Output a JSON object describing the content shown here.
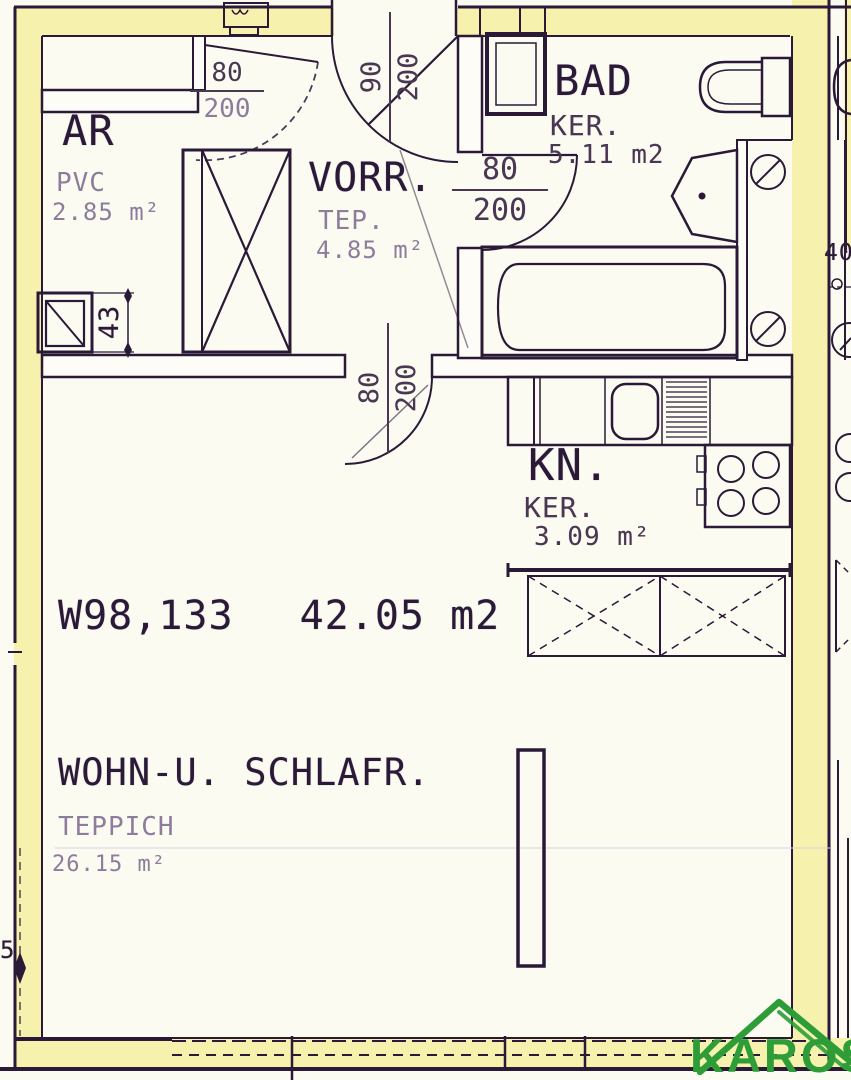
{
  "colors": {
    "highlight": "#f6f2ae",
    "paper": "#fcfbf2",
    "ink": "#2a1a38",
    "mid": "#4a3752",
    "faint": "#8d7c9c",
    "logo_green": "#2e9d38"
  },
  "plan": {
    "unit_id": "W98,133",
    "total_area": "42.05 m2"
  },
  "rooms": {
    "ar": {
      "name": "AR",
      "floor": "PVC",
      "area": "2.85 m²"
    },
    "vorr": {
      "name": "VORR.",
      "floor": "TEP.",
      "area": "4.85 m²"
    },
    "bad": {
      "name": "BAD",
      "floor": "KER.",
      "area": "5.11 m2"
    },
    "kn": {
      "name": "KN.",
      "floor": "KER.",
      "area": "3.09 m²"
    },
    "wohn": {
      "name": "WOHN-U. SCHLAFR.",
      "floor": "TEPPICH",
      "area": "26.15 m²"
    }
  },
  "doors": {
    "entrance": {
      "width": "90",
      "height": "200"
    },
    "ar": {
      "width": "80",
      "height": "200"
    },
    "bad": {
      "width": "80",
      "height": "200"
    },
    "wohn": {
      "width": "80",
      "height": "200"
    }
  },
  "dimensions": {
    "shaft_width": "43",
    "right_mark": "40",
    "left_mark": "5"
  },
  "logo": {
    "text": "KAROS"
  }
}
